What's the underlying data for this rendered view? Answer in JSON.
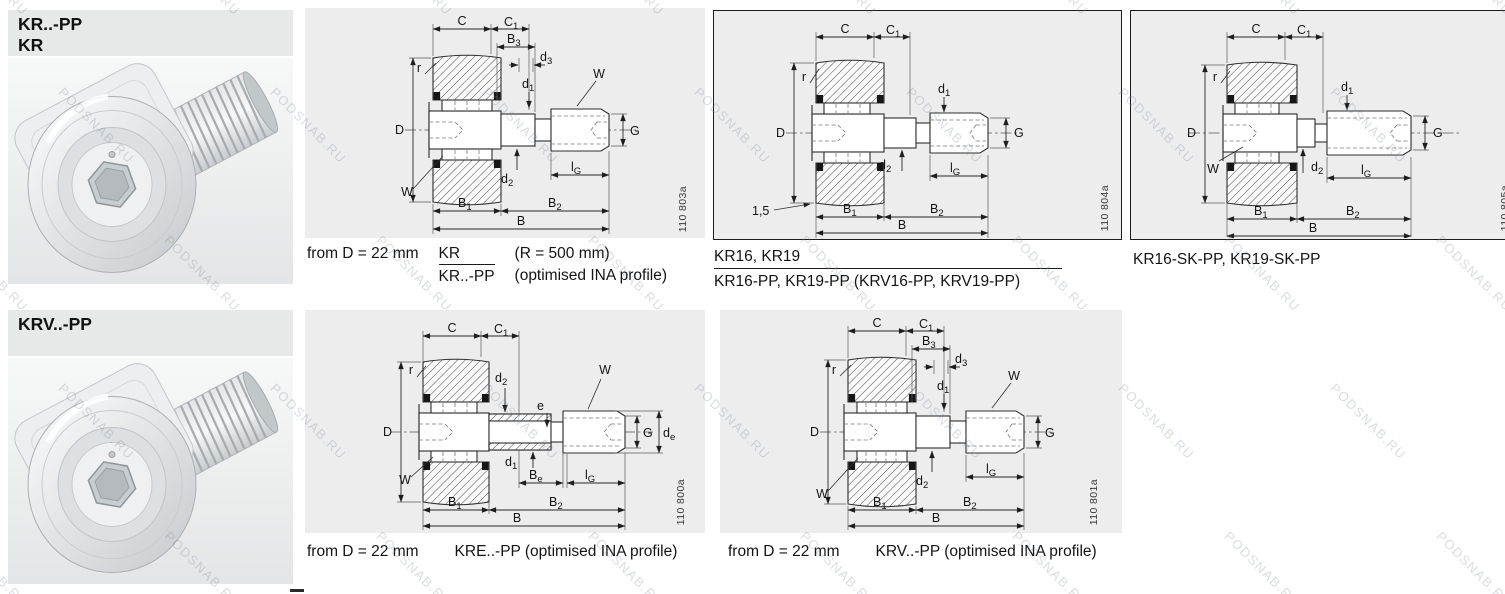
{
  "watermark": {
    "text": "PODSNAB.RU"
  },
  "headers": {
    "kr": {
      "line1": "KR..-PP",
      "line2": "KR"
    },
    "krv": {
      "line1": "KRV..-PP"
    }
  },
  "dims": {
    "C": "C",
    "C1": {
      "m": "C",
      "s": "1"
    },
    "B3": {
      "m": "B",
      "s": "3"
    },
    "d3": {
      "m": "d",
      "s": "3"
    },
    "d1": {
      "m": "d",
      "s": "1"
    },
    "d2": {
      "m": "d",
      "s": "2"
    },
    "W": "W",
    "r": "r",
    "D": "D",
    "G": "G",
    "lG": {
      "m": "l",
      "s": "G"
    },
    "B1": {
      "m": "B",
      "s": "1"
    },
    "B2": {
      "m": "B",
      "s": "2"
    },
    "B": "B",
    "Be": {
      "m": "B",
      "s": "e"
    },
    "de": {
      "m": "d",
      "s": "e"
    },
    "e": "e",
    "chamfer": "1,5"
  },
  "figures": {
    "kr": "110 803a",
    "kr16": "110 804a",
    "kr16sk": "110 805a",
    "kre": "110 800a",
    "krv": "110 801a"
  },
  "captions": {
    "kr": {
      "prefix": "from D = 22 mm",
      "frac_top": "KR",
      "frac_bottom": "KR..-PP",
      "note_top": "(R = 500 mm)",
      "note_bottom": "(optimised INA profile)"
    },
    "kr16": {
      "line1": "KR16, KR19",
      "line2": "KR16-PP, KR19-PP (KRV16-PP, KRV19-PP)"
    },
    "kr16sk": {
      "line1": "KR16-SK-PP, KR19-SK-PP"
    },
    "kre": {
      "prefix": "from D = 22 mm",
      "label": "KRE..-PP (optimised INA profile)"
    },
    "krv": {
      "prefix": "from D = 22 mm",
      "label": "KRV..-PP (optimised INA profile)"
    }
  }
}
